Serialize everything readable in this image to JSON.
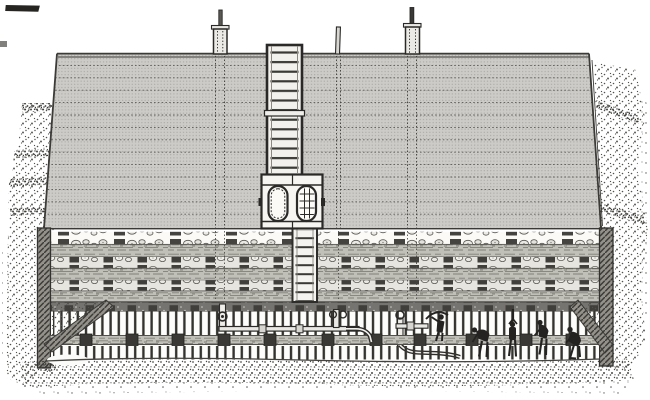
{
  "meta": {
    "title": "Nineteenth-century engraving: cross-section of a covered mound over a timbered underground gallery with workmen",
    "style": "black-and-white line engraving on white paper",
    "visible_text": "none"
  },
  "palette": {
    "paper": "#ffffff",
    "ink": "#2a2927",
    "mound_fill": "#cccbc7",
    "mound_dot": "#a09f9a",
    "wood": "#c0bfb8",
    "wall_hatch": "#93918a",
    "sill_dark": "#767470",
    "block_dark": "#403f3b",
    "stipple_dark": "#4b4a45",
    "figure_ink": "#242321"
  },
  "scene": {
    "mound": {
      "description": "large layered trapezoidal mound with halftone shading",
      "layer_lines": 13,
      "vertical_probe_lines": 3
    },
    "surface_pipes": [
      {
        "name": "left-vent-pipe",
        "x": 220,
        "has_flange": true
      },
      {
        "name": "center-thin-rod",
        "x": 338,
        "has_flange": false
      },
      {
        "name": "right-vent-pipe",
        "x": 412,
        "has_flange": true
      }
    ],
    "central_shaft": {
      "description": "ringed masonry shaft through mound",
      "chamber_ports": 2,
      "port_left": "plain oval opening",
      "port_right": "latticed oval opening"
    },
    "timber_zone": {
      "log_courses": 3,
      "stone_courses": 3,
      "cap_sill": "dark stippled sill over gallery"
    },
    "gallery": {
      "upper_props": "row of closely spaced vertical props",
      "lower_props": "row of closely spaced vertical props",
      "waling_beam_blocks": 11,
      "end_braces": 2,
      "pipework": "valved air/water main with hand-wheels and hose",
      "hand_wheels": 3
    },
    "workmen": [
      {
        "pose": "swinging a pick"
      },
      {
        "pose": "bending over hose"
      },
      {
        "pose": "driving a bar overhead"
      },
      {
        "pose": "stooping at face"
      },
      {
        "pose": "crouching by end brace"
      }
    ],
    "ground": "stippled earth banks at both sides and along the bottom"
  }
}
